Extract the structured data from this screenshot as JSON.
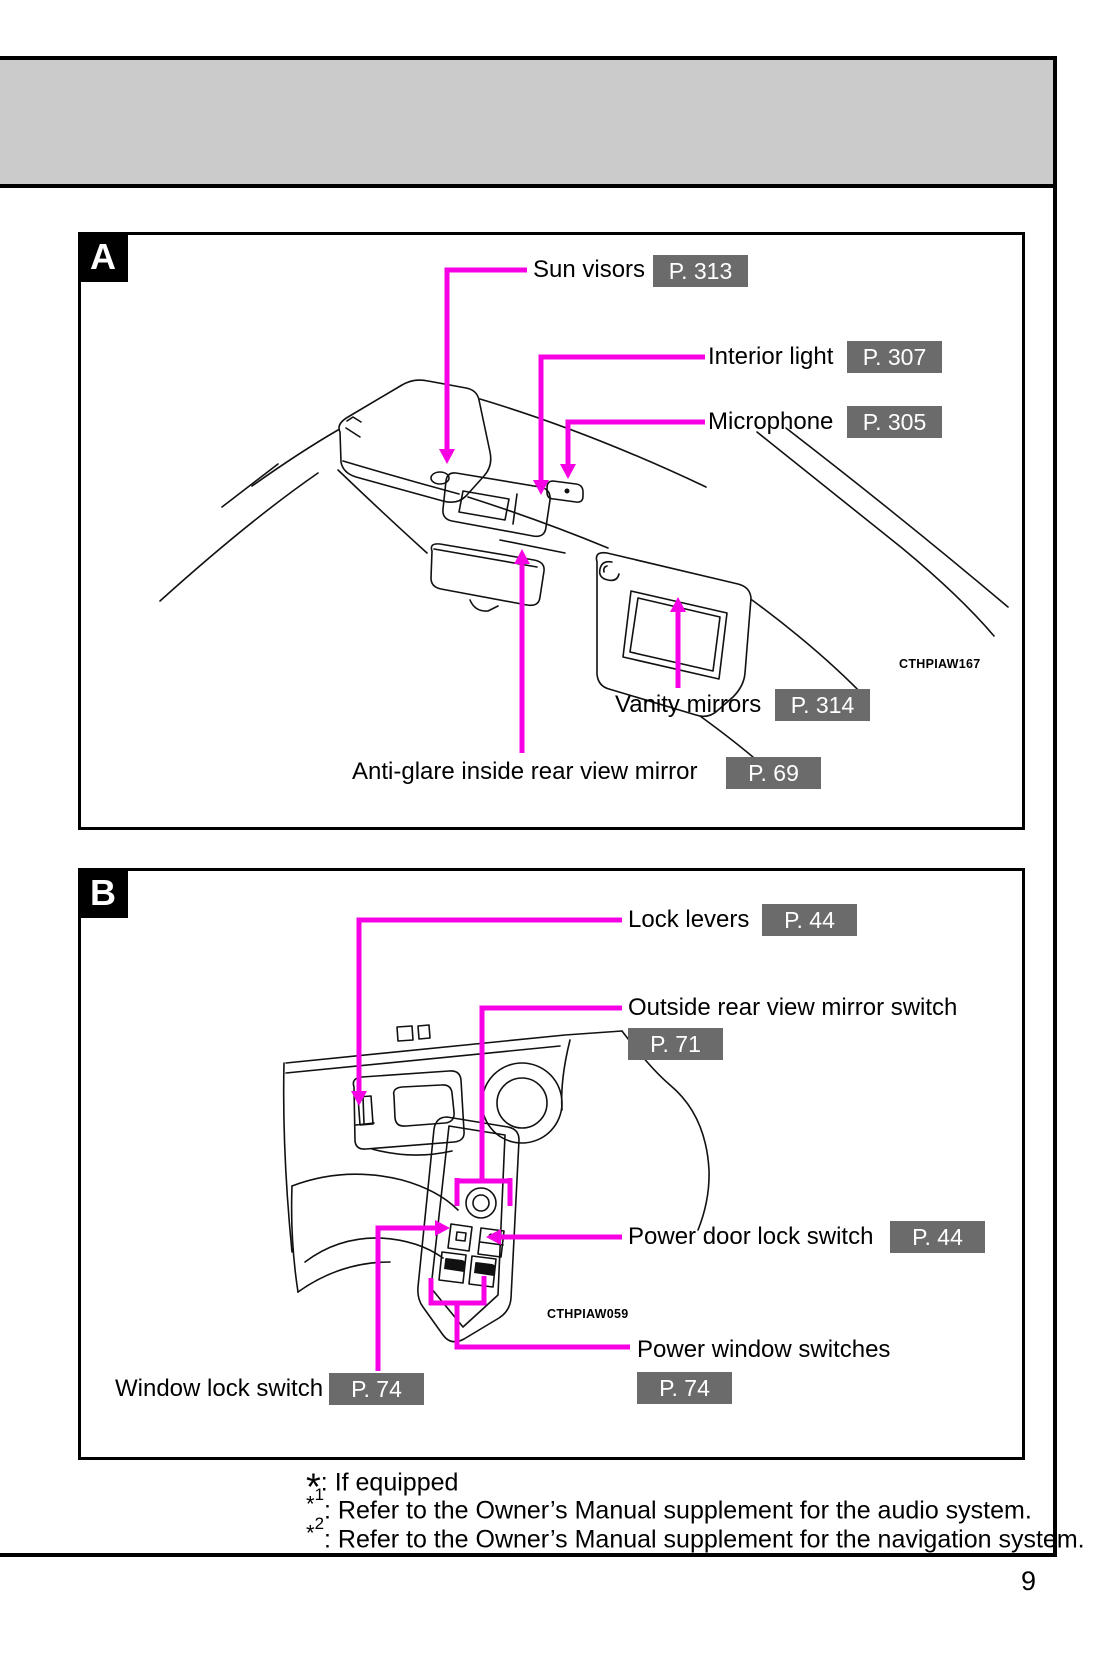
{
  "page": {
    "number": "9",
    "panels": [
      {
        "label": "A",
        "image_code": "CTHPIAW167",
        "callouts": [
          {
            "text": "Sun visors",
            "page_ref": "P. 313"
          },
          {
            "text": "Interior light",
            "page_ref": "P. 307"
          },
          {
            "text": "Microphone",
            "page_ref": "P. 305"
          },
          {
            "text": "Vanity mirrors",
            "page_ref": "P. 314"
          },
          {
            "text": "Anti-glare inside rear view mirror",
            "page_ref": "P. 69"
          }
        ]
      },
      {
        "label": "B",
        "image_code": "CTHPIAW059",
        "callouts": [
          {
            "text": "Lock levers",
            "page_ref": "P. 44"
          },
          {
            "text": "Outside rear view mirror switch",
            "page_ref": "P. 71"
          },
          {
            "text": "Power door lock switch",
            "page_ref": "P. 44"
          },
          {
            "text": "Power window switches",
            "page_ref": "P. 74"
          },
          {
            "text": "Window lock switch",
            "page_ref": "P. 74"
          }
        ]
      }
    ],
    "footnotes": [
      {
        "marker": "*",
        "sup": "",
        "text": ": If equipped"
      },
      {
        "marker": "*",
        "sup": "1",
        "text": ": Refer to the Owner’s Manual supplement for the audio system."
      },
      {
        "marker": "*",
        "sup": "2",
        "text": ": Refer to the Owner’s Manual supplement for the navigation system."
      }
    ],
    "colors": {
      "accent": "#f700e3",
      "badge_bg": "#6b6b6b",
      "header_bg": "#cbcbcb"
    }
  }
}
